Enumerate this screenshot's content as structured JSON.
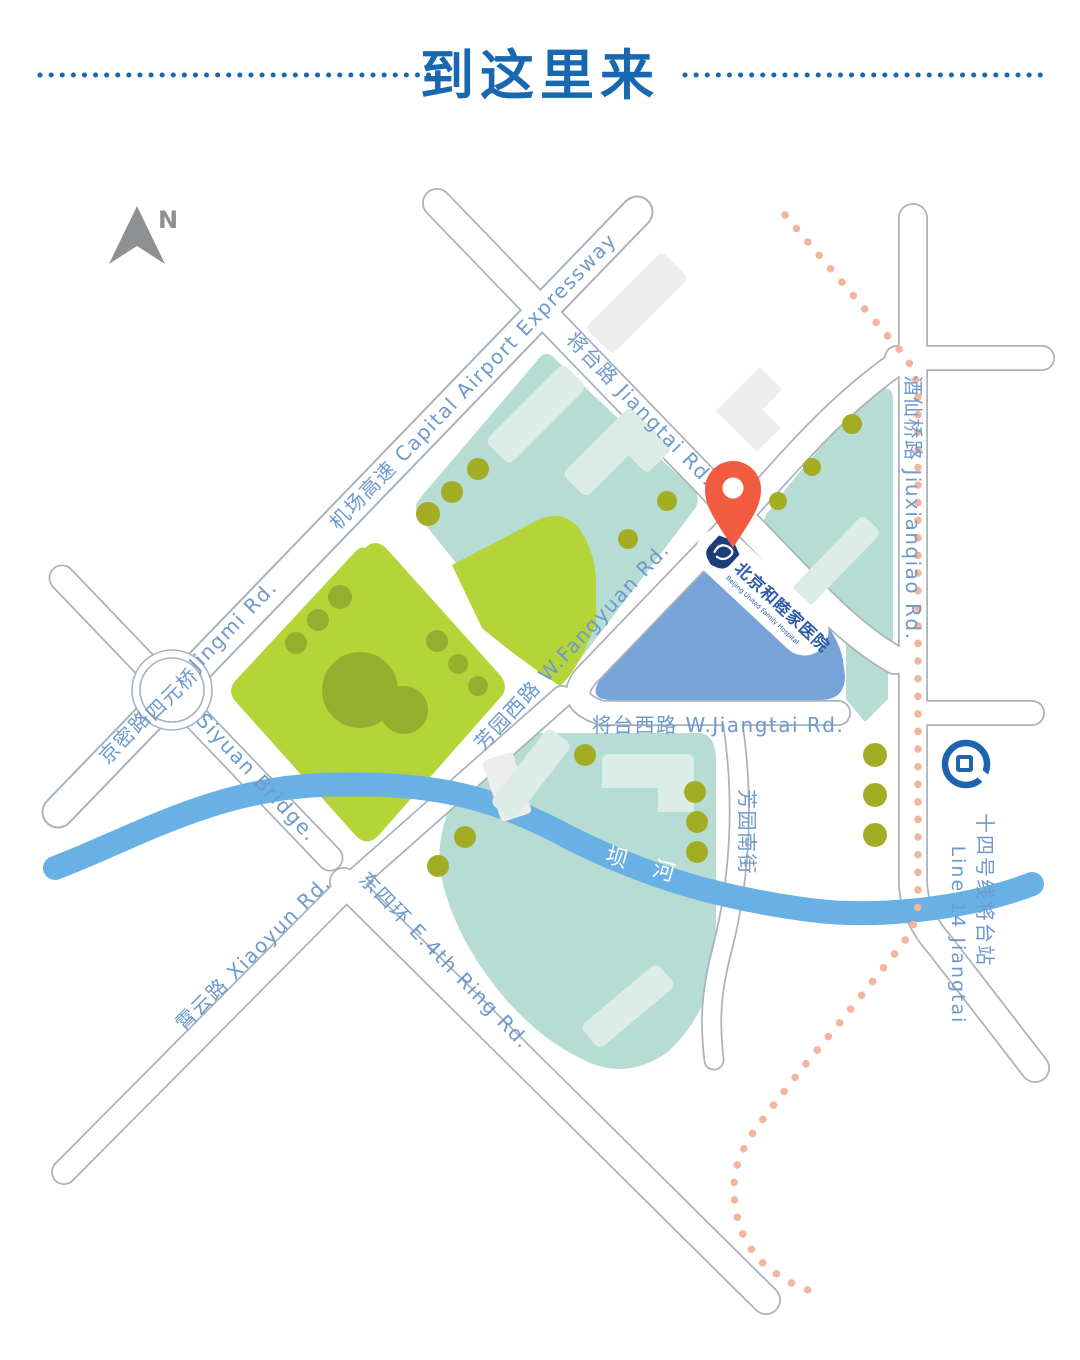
{
  "title": {
    "text": "到这里来"
  },
  "compass": {
    "label": "N"
  },
  "roads": {
    "expressway": "机场高速  Capital Airport Expressway",
    "jiangtai": "将台路 Jiangtai Rd.",
    "jiuxianqiao": "酒仙桥路  Jiuxianqiao Rd.",
    "jingmi_cn": "京密路",
    "jingmi_en": "Jingmi Rd.",
    "siyuan_bridge": "Siyuan Bridge.",
    "xiaoyun": "霄云路  Xiaoyun Rd.",
    "e4th_ring": "东四环  E.4th Ring Rd.",
    "fangyuan_w": "芳园西路  W.Fangyuan Rd.",
    "jiangtai_w": "将台西路  W.Jiangtai Rd.",
    "fangyuan_s": "芳园南街"
  },
  "landmarks": {
    "siyuan_circle": "四元桥",
    "river": "坝 河",
    "station_cn": "十四号线将台站",
    "station_en": "Line 14 Jiangtai"
  },
  "hospital": {
    "name_cn": "北京和睦家医院",
    "name_en": "Beijing United Family Hospital"
  },
  "colors": {
    "title": "#1a67b1",
    "label": "#6d99cd",
    "road_outline": "#a9b3bb",
    "teal": "#b7dcd3",
    "teal_light": "#dcede7",
    "lime": "#b5d438",
    "lime_dark": "#97ad2d",
    "olive": "#a2ad24",
    "river": "#69b1e4",
    "block_blue": "#78a3d8",
    "pin": "#f15b40",
    "transit_dots": "#f3b69c",
    "gray_building": "#ededed",
    "navy": "#1c3e78",
    "subway": "#1e63ad",
    "arrow": "#8f9091"
  }
}
